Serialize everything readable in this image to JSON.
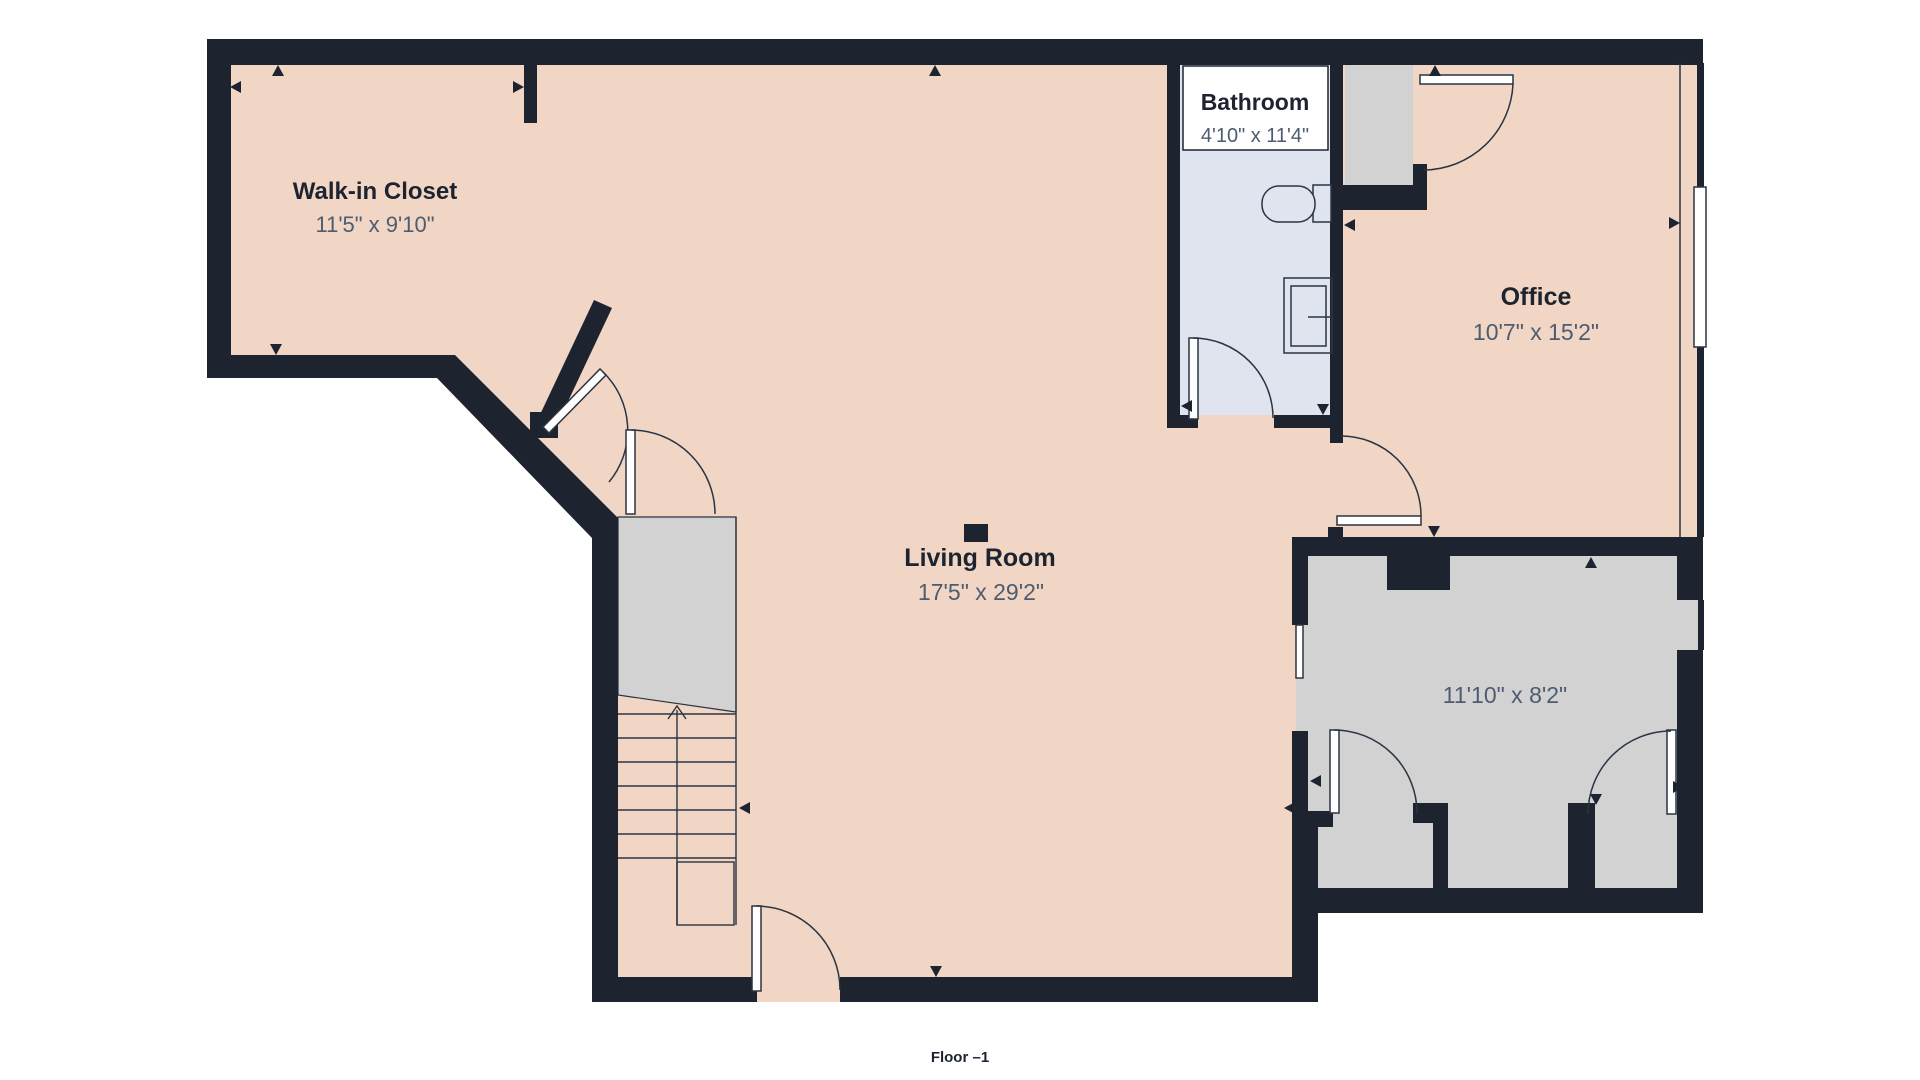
{
  "floor_label": "Floor –1",
  "rooms": {
    "walk_in_closet": {
      "name": "Walk-in Closet",
      "dimensions": "11'5\" x 9'10\""
    },
    "bathroom": {
      "name": "Bathroom",
      "dimensions": "4'10\" x 11'4\""
    },
    "office": {
      "name": "Office",
      "dimensions": "10'7\" x 15'2\""
    },
    "living_room": {
      "name": "Living Room",
      "dimensions": "17'5\" x 29'2\""
    },
    "utility_room": {
      "name": "",
      "dimensions": "11'10\" x 8'2\""
    }
  },
  "colors": {
    "wall": "#1d2430",
    "room_fill": "#f1d6c5",
    "bathroom_fill": "#dfe4ee",
    "gray_fill": "#d2d2d3",
    "dimension_text": "#4d5c6f",
    "name_text": "#1d2430",
    "background": "#ffffff"
  }
}
